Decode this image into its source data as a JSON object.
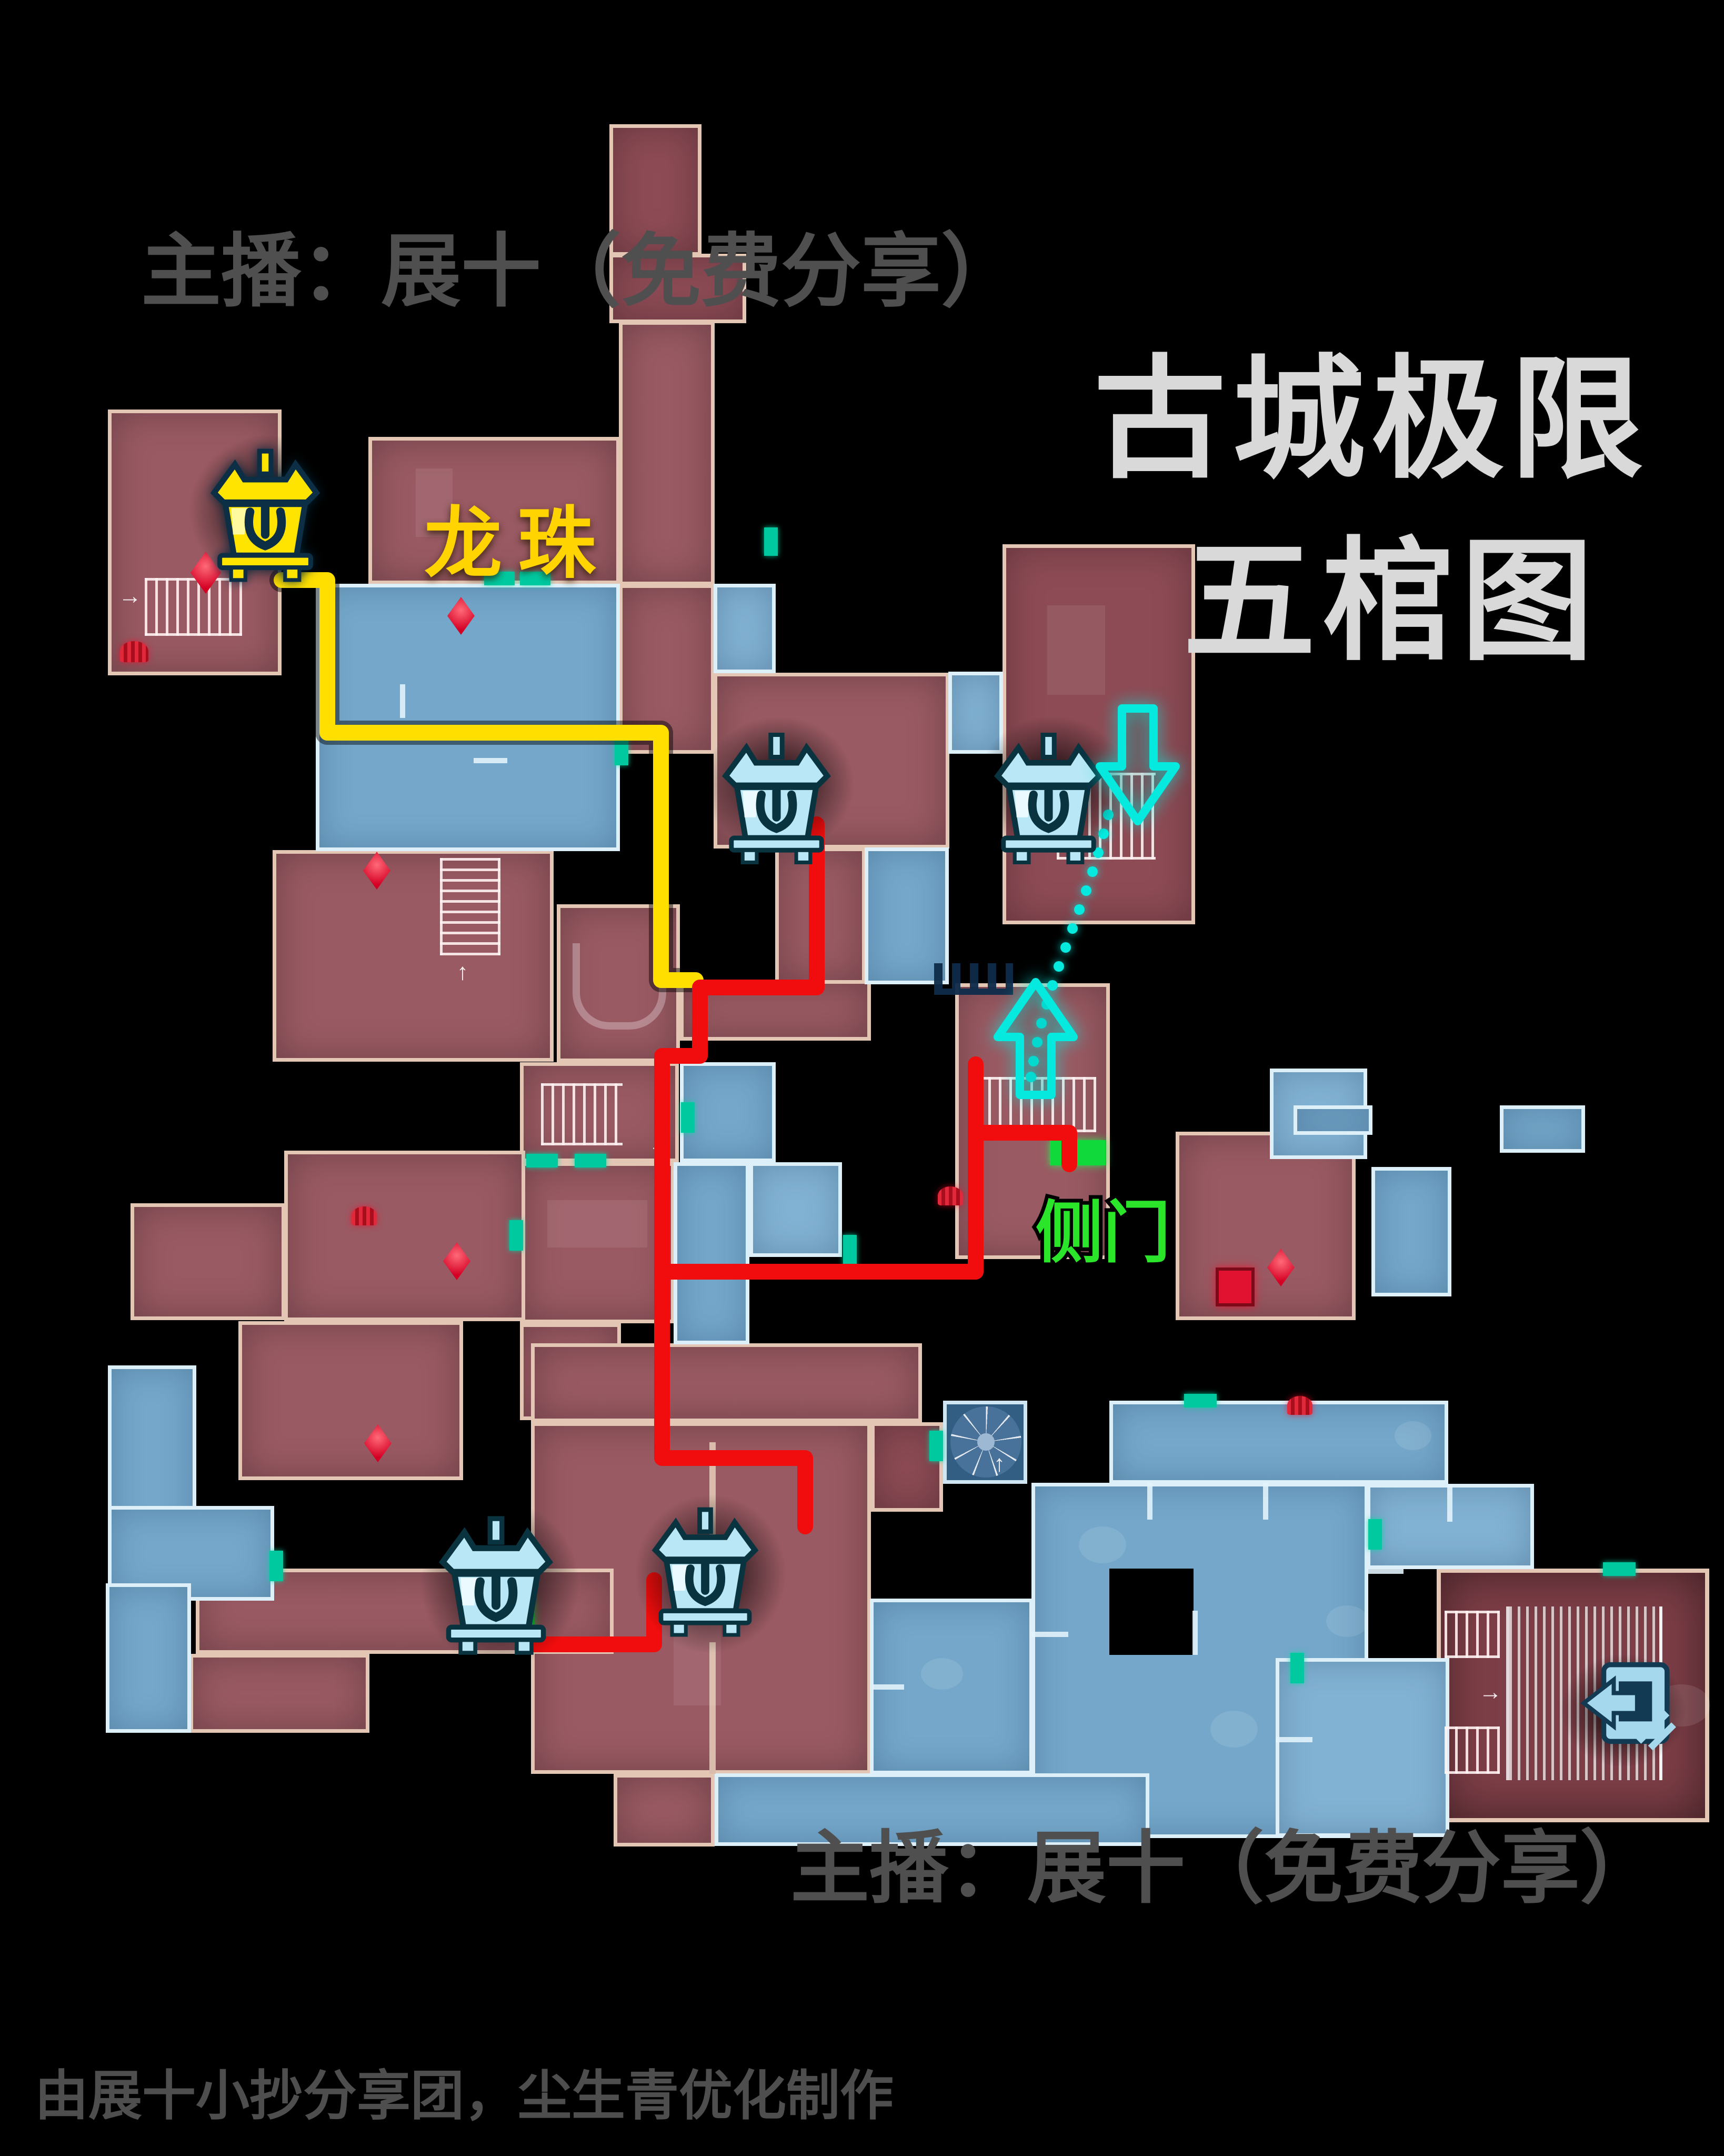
{
  "header": {
    "streamer_label": "主播：展十（免费分享）"
  },
  "title": {
    "line1": "古城极限",
    "line2": "五棺图"
  },
  "map_labels": {
    "dragon_pearl": "龙珠",
    "side_door": "侧门"
  },
  "footer": {
    "streamer_label": "主播：展十（免费分享）",
    "credit_label": "由展十小抄分享团，尘生青优化制作"
  },
  "icons": {
    "coffins": [
      {
        "name": "coffin-yellow",
        "color": "#ffe32a"
      },
      {
        "name": "coffin-cyan-top-middle",
        "color": "#b9e7f5"
      },
      {
        "name": "coffin-cyan-top-right",
        "color": "#b9e7f5"
      },
      {
        "name": "coffin-cyan-bottom-left",
        "color": "#b9e7f5"
      },
      {
        "name": "coffin-cyan-bottom-middle",
        "color": "#b9e7f5"
      }
    ],
    "exit_door": {
      "name": "exit-door-icon",
      "color": "#a5d8ec"
    },
    "arrows": [
      {
        "name": "arrow-down-cyan"
      },
      {
        "name": "arrow-up-cyan"
      }
    ],
    "mini_arrows": {
      "right": "→",
      "up": "↑",
      "left": "←"
    }
  },
  "colors": {
    "background": "#000000",
    "room_red": "#9a5a63",
    "room_red_border": "#e3c6b4",
    "room_blue": "#74a7ca",
    "room_blue_border": "#ddeff8",
    "route_yellow": "#ffdf00",
    "route_red": "#f10d0d",
    "accent_cyan": "#06e9de",
    "accent_green": "#2be52b",
    "door_teal": "#00c9a0",
    "gem_red": "#e8002a",
    "title_text": "#d9d9d9",
    "watermark_text": "#4f4f4f"
  }
}
